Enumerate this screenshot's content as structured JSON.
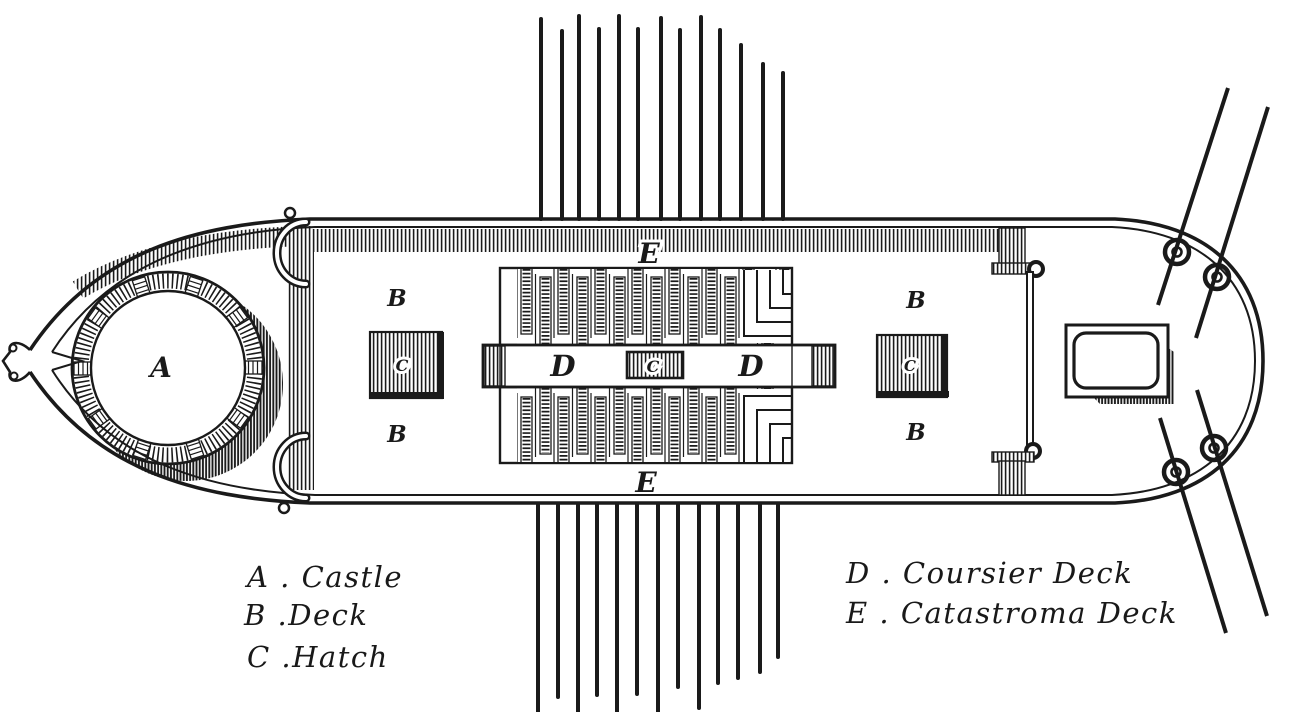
{
  "colors": {
    "ink": "#1a1a1a",
    "paper": "#ffffff"
  },
  "labels": {
    "castle": "A",
    "deck": "B",
    "hatch": "C",
    "coursier": "D",
    "catastroma": "E"
  },
  "legend": {
    "left": [
      "A . Castle",
      "B .Deck",
      "C .Hatch"
    ],
    "right": [
      "D . Coursier Deck",
      "E . Catastroma Deck"
    ]
  }
}
